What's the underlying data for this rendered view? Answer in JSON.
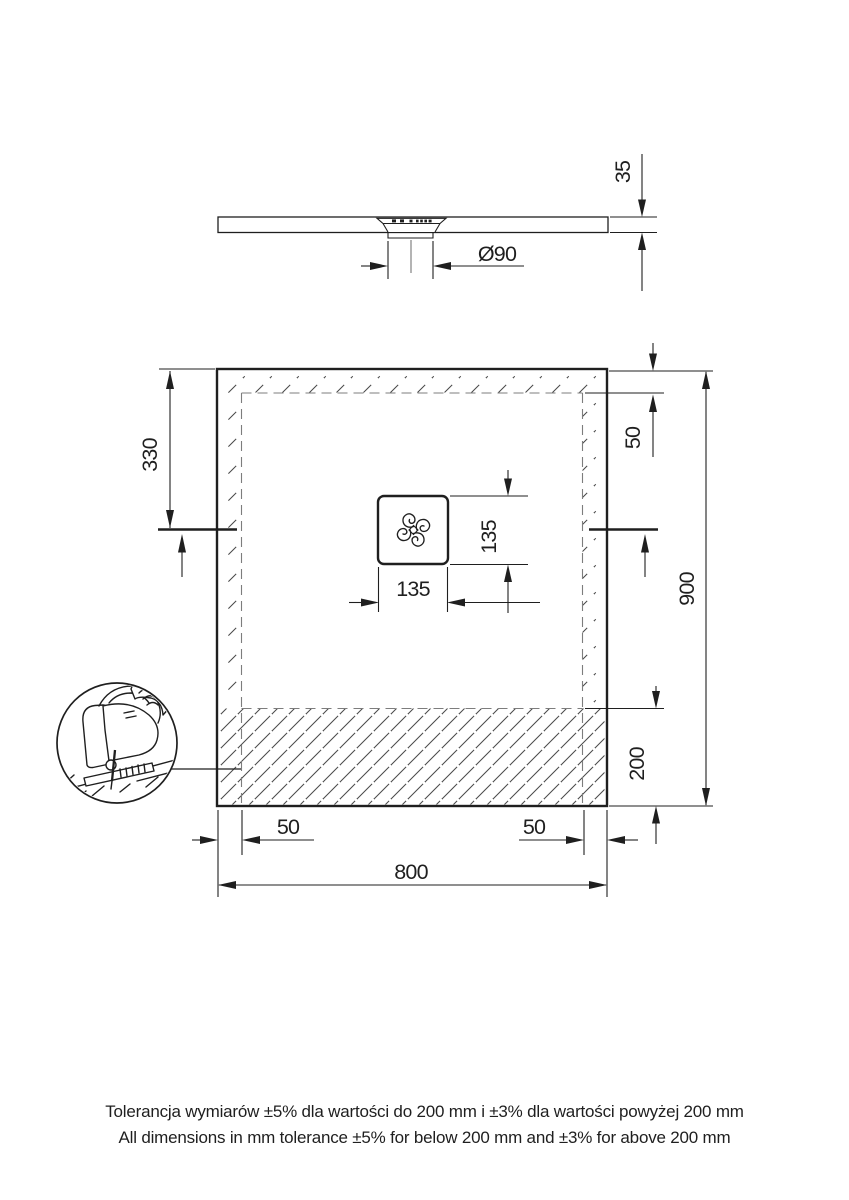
{
  "drawing": {
    "side_view": {
      "thickness_label": "35",
      "drain_diameter_label": "Ø90"
    },
    "plan_view": {
      "drain_offset_left_label": "330",
      "top_inset_label": "50",
      "drain_width_label": "135",
      "drain_height_label": "135",
      "height_label": "900",
      "cut_zone_label": "200",
      "bottom_left_inset_label": "50",
      "bottom_right_inset_label": "50",
      "width_label": "800"
    },
    "notes": {
      "tolerance_pl": "Tolerancja wymiarów ±5% dla wartości do 200 mm i ±3% dla wartości powyżej 200 mm",
      "tolerance_en": "All dimensions in mm tolerance ±5% for below 200 mm and ±3% for above 200 mm"
    },
    "colors": {
      "line": "#1f1f1f",
      "hatch": "#3c3c3c",
      "dashed": "#7d7d7d",
      "background": "#ffffff"
    }
  }
}
